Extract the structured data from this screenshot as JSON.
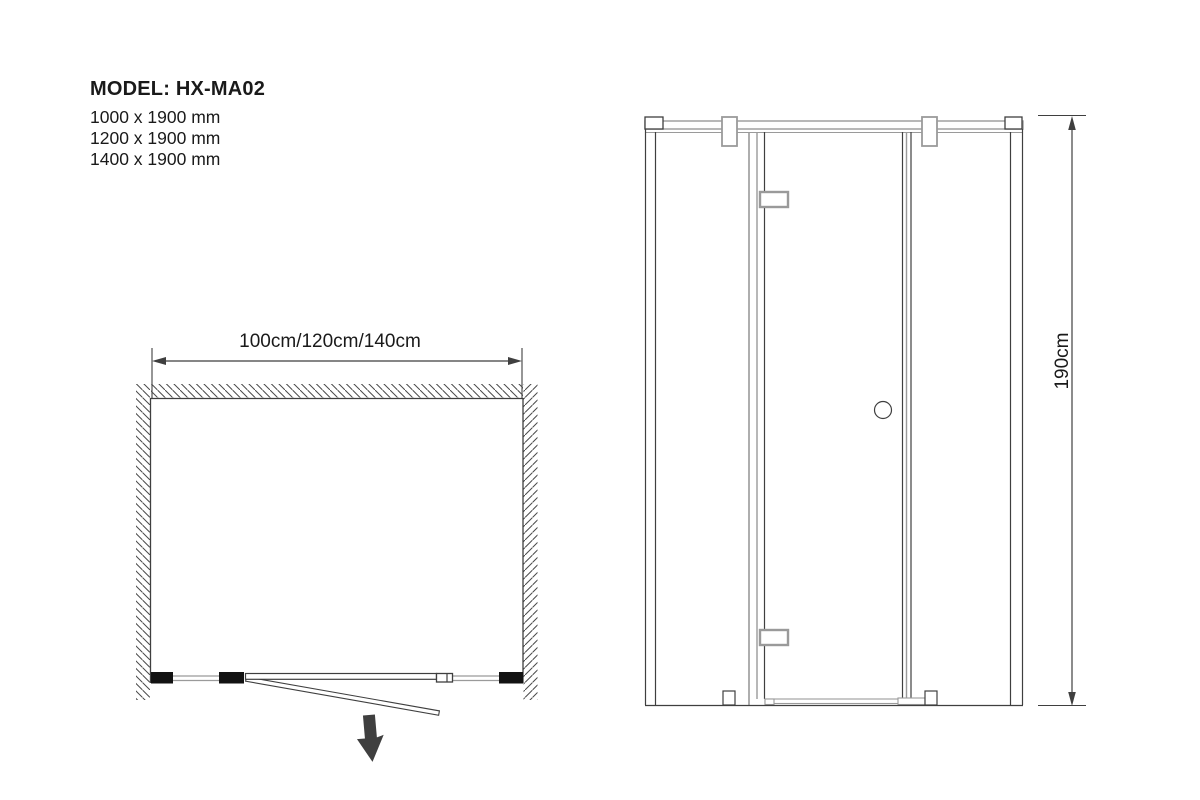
{
  "page": {
    "background": "#ffffff"
  },
  "colors": {
    "line_dark": "#3f3f3f",
    "line_gray": "#9a9a9a",
    "fill_black": "#121212",
    "text": "#1a1a1a"
  },
  "header": {
    "model_label": "MODEL: HX-MA02",
    "sizes": [
      "1000 x 1900 mm",
      "1200 x 1900 mm",
      "1400 x 1900 mm"
    ]
  },
  "plan_view": {
    "width_dimension_label": "100cm/120cm/140cm"
  },
  "elevation_view": {
    "height_dimension_label": "190cm"
  }
}
